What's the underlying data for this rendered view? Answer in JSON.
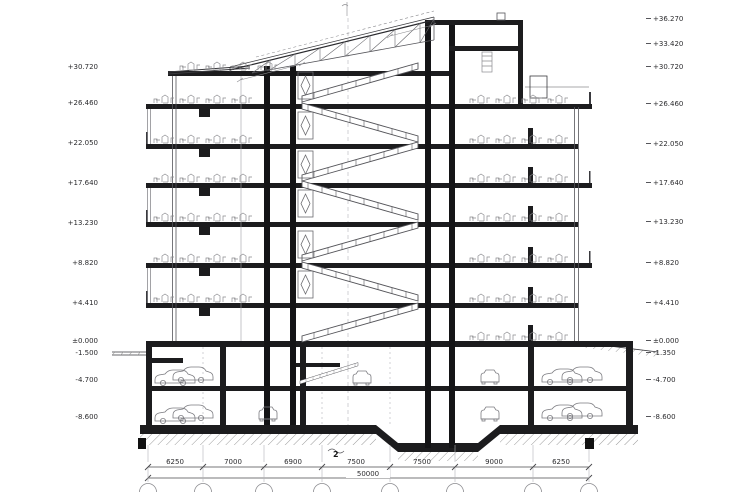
{
  "section": {
    "levels_left": [
      "+30.720",
      "+26.460",
      "+22.050",
      "+17.640",
      "+13.230",
      "+8.820",
      "+4.410",
      "±0.000",
      "-1.500",
      "-4.700",
      "-8.600"
    ],
    "levels_right": [
      "+36.270",
      "+33.420",
      "+30.720",
      "+26.460",
      "+22.050",
      "+17.640",
      "+13.230",
      "+8.820",
      "+4.410",
      "±0.000",
      "-1.350",
      "-4.700",
      "-8.600"
    ],
    "dimensions": [
      "6250",
      "7000",
      "6900",
      "7500",
      "7500",
      "9000",
      "6250"
    ],
    "total_dimension": "50000",
    "section_marker": "2",
    "line_color": "#1c1c1e",
    "detail_color": "#8b8b8f"
  }
}
